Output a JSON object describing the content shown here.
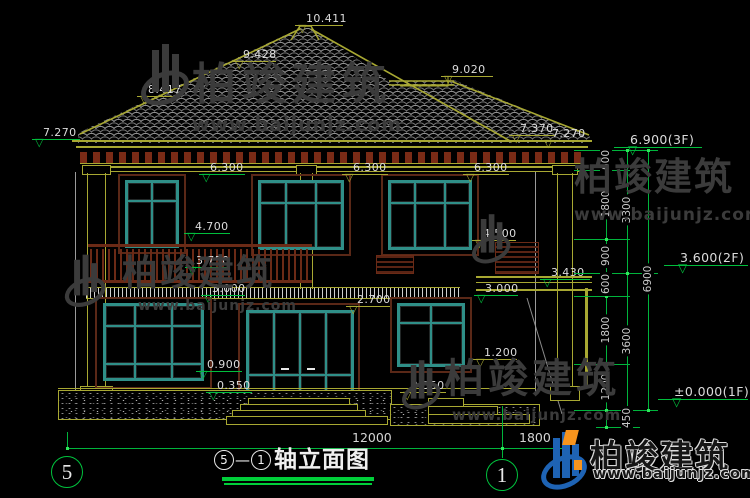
{
  "watermark": {
    "name": "柏竣建筑",
    "url": "www.baijunjz.com"
  },
  "brand_footer": {
    "name": "柏竣建筑",
    "url": "www.baijunjz.com"
  },
  "drawing_title": {
    "axis_from": "5",
    "dash": "—",
    "axis_to": "1",
    "text": "轴立面图"
  },
  "axis_bubbles": {
    "left": "5",
    "right": "1"
  },
  "marks": [
    "10.411",
    "9.428",
    "8.417",
    "9.020",
    "7.370",
    "7.270",
    "7.270",
    "6.300",
    "6.300",
    "6.300",
    "4.700",
    "4.500",
    "3.750",
    "3.000",
    "3.430",
    "3.000",
    "2.700",
    "1.200",
    "0.900",
    "0.350",
    "0.350"
  ],
  "floor_marks": [
    "6.900(3F)",
    "3.600(2F)",
    "±0.000(1F)"
  ],
  "right_dims": {
    "col1": [
      "600",
      "1800",
      "900",
      "600",
      "1800",
      "1200"
    ],
    "col2": [
      "3300",
      "3600",
      "450"
    ],
    "col3": [
      "6900"
    ]
  },
  "bottom_dims": [
    "12000",
    "1800"
  ]
}
